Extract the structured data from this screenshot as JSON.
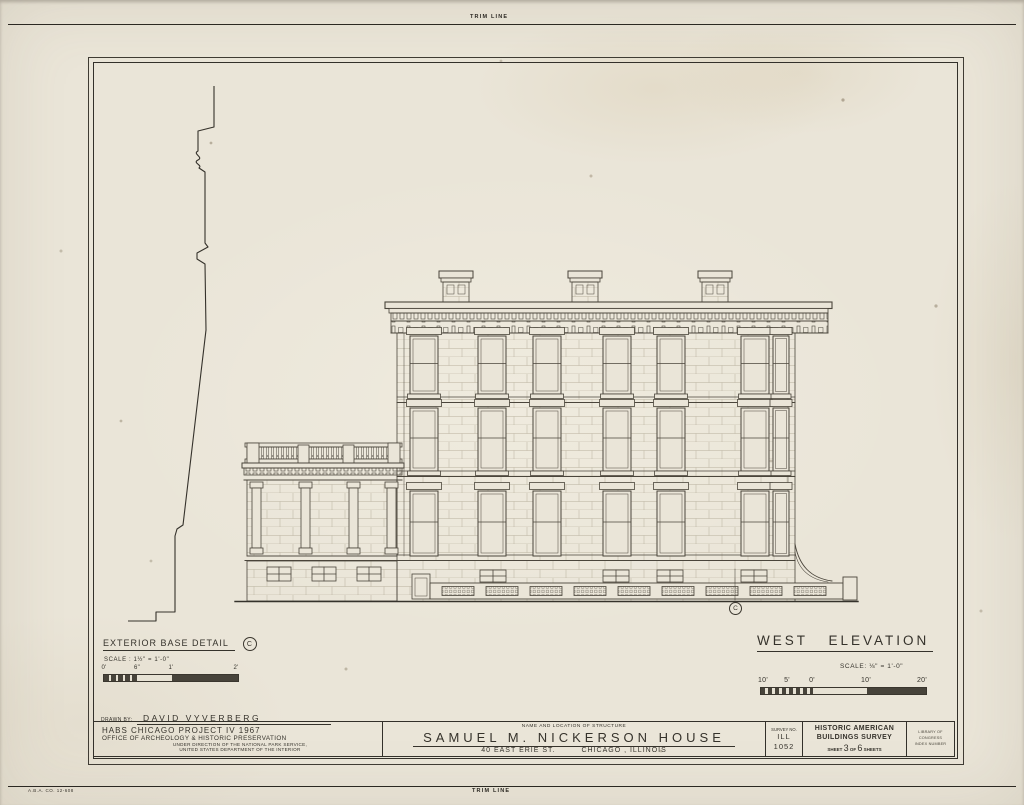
{
  "colors": {
    "paper": "#eae5d8",
    "ink": "#35322b",
    "line": "#4a453b"
  },
  "sheet": {
    "trim_top": "TRIM LINE",
    "trim_bottom": "TRIM LINE",
    "printer_code": "A.B.A. CO. 12-608"
  },
  "base_detail": {
    "title": "EXTERIOR BASE DETAIL",
    "marker": "C",
    "scale_label": "SCALE : 1½\" = 1'-0\"",
    "ticks": [
      "0'",
      "6\"",
      "1'",
      "2'"
    ]
  },
  "west_elevation": {
    "title": "WEST ELEVATION",
    "scale_label": "SCALE: ⅛\" = 1'-0\"",
    "ticks": [
      "10'",
      "5'",
      "0'",
      "10'",
      "20'"
    ],
    "detail_marker": "C"
  },
  "title_block": {
    "drawn_by_label": "DRAWN BY:",
    "drawn_by_value": "DAVID VYVERBERG",
    "project": "HABS CHICAGO PROJECT IV 1967",
    "office": "OFFICE OF ARCHEOLOGY & HISTORIC PRESERVATION",
    "direction1": "UNDER DIRECTION OF THE NATIONAL PARK SERVICE,",
    "direction2": "UNITED STATES DEPARTMENT OF THE INTERIOR",
    "structure_heading": "NAME AND LOCATION OF STRUCTURE",
    "structure_name": "SAMUEL M. NICKERSON HOUSE",
    "address_street": "40 EAST ERIE ST.",
    "address_city": "CHICAGO , ILLINOIS",
    "survey_heading": "SURVEY NO.",
    "survey_state": "ILL",
    "survey_number": "1052",
    "habs_line1": "HISTORIC AMERICAN",
    "habs_line2": "BUILDINGS SURVEY",
    "sheet_word": "SHEET",
    "sheet_number": "3",
    "of_word": "OF",
    "sheet_total": "6",
    "sheets_word": "SHEETS",
    "loc_line1": "LIBRARY OF CONGRESS",
    "loc_line2": "INDEX NUMBER"
  }
}
